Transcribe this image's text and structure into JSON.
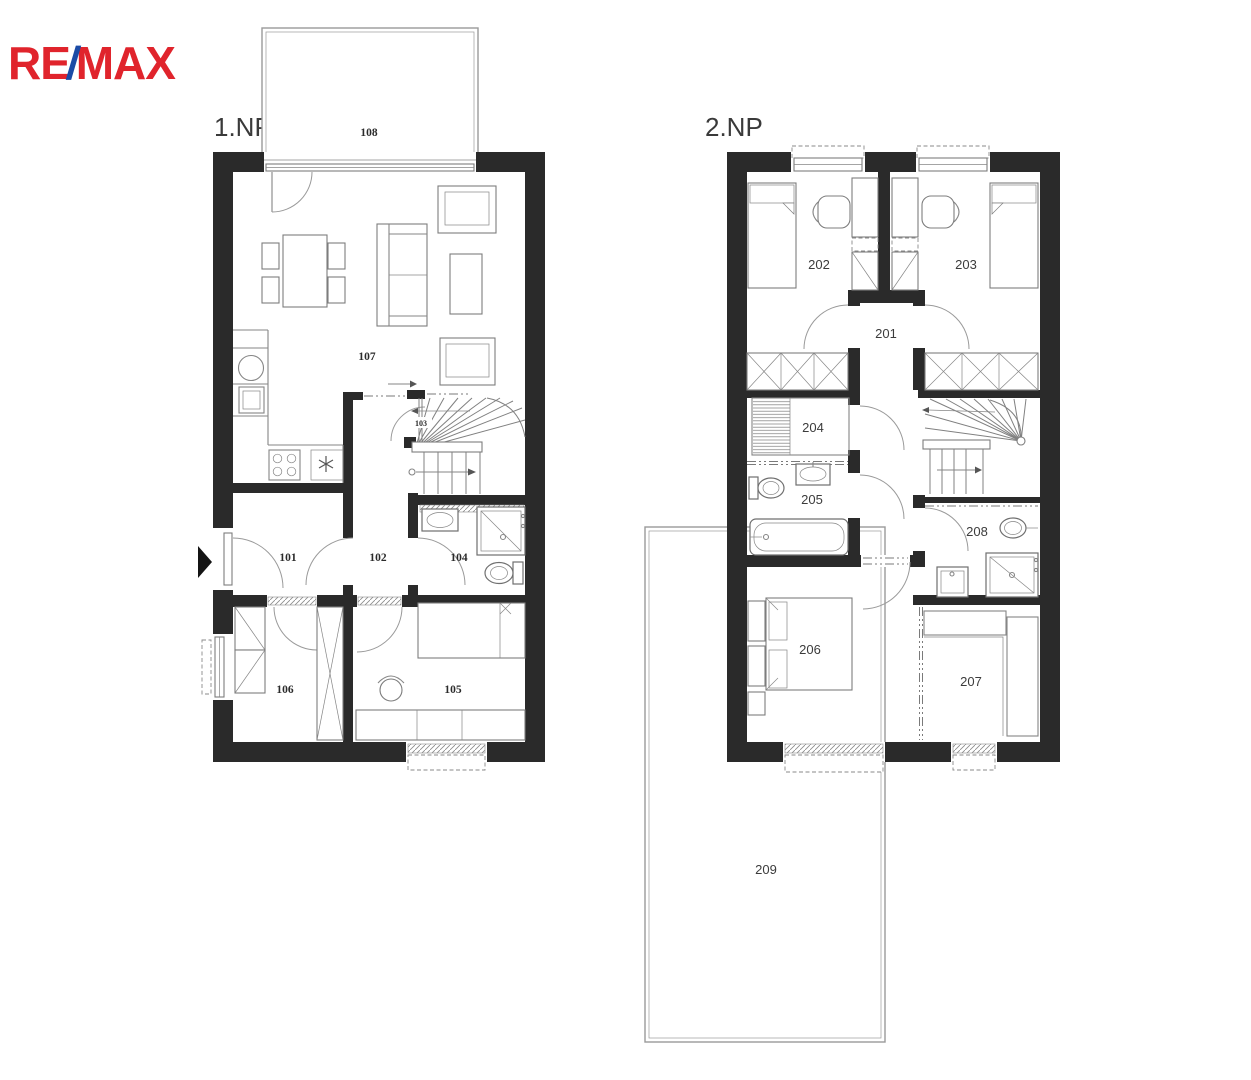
{
  "logo": {
    "re": "RE",
    "slash": "/",
    "max": "MAX"
  },
  "floors": {
    "floor1": {
      "label": "1.NP",
      "rooms": [
        "101",
        "102",
        "103",
        "104",
        "105",
        "106",
        "107",
        "108"
      ]
    },
    "floor2": {
      "label": "2.NP",
      "rooms": [
        "201",
        "202",
        "203",
        "204",
        "205",
        "206",
        "207",
        "208",
        "209"
      ]
    }
  },
  "colors": {
    "wall": "#2a2a2a",
    "logo-red": "#e0242c",
    "logo-blue": "#1b4ba6",
    "line": "#868686",
    "label": "#2b2b2b"
  }
}
